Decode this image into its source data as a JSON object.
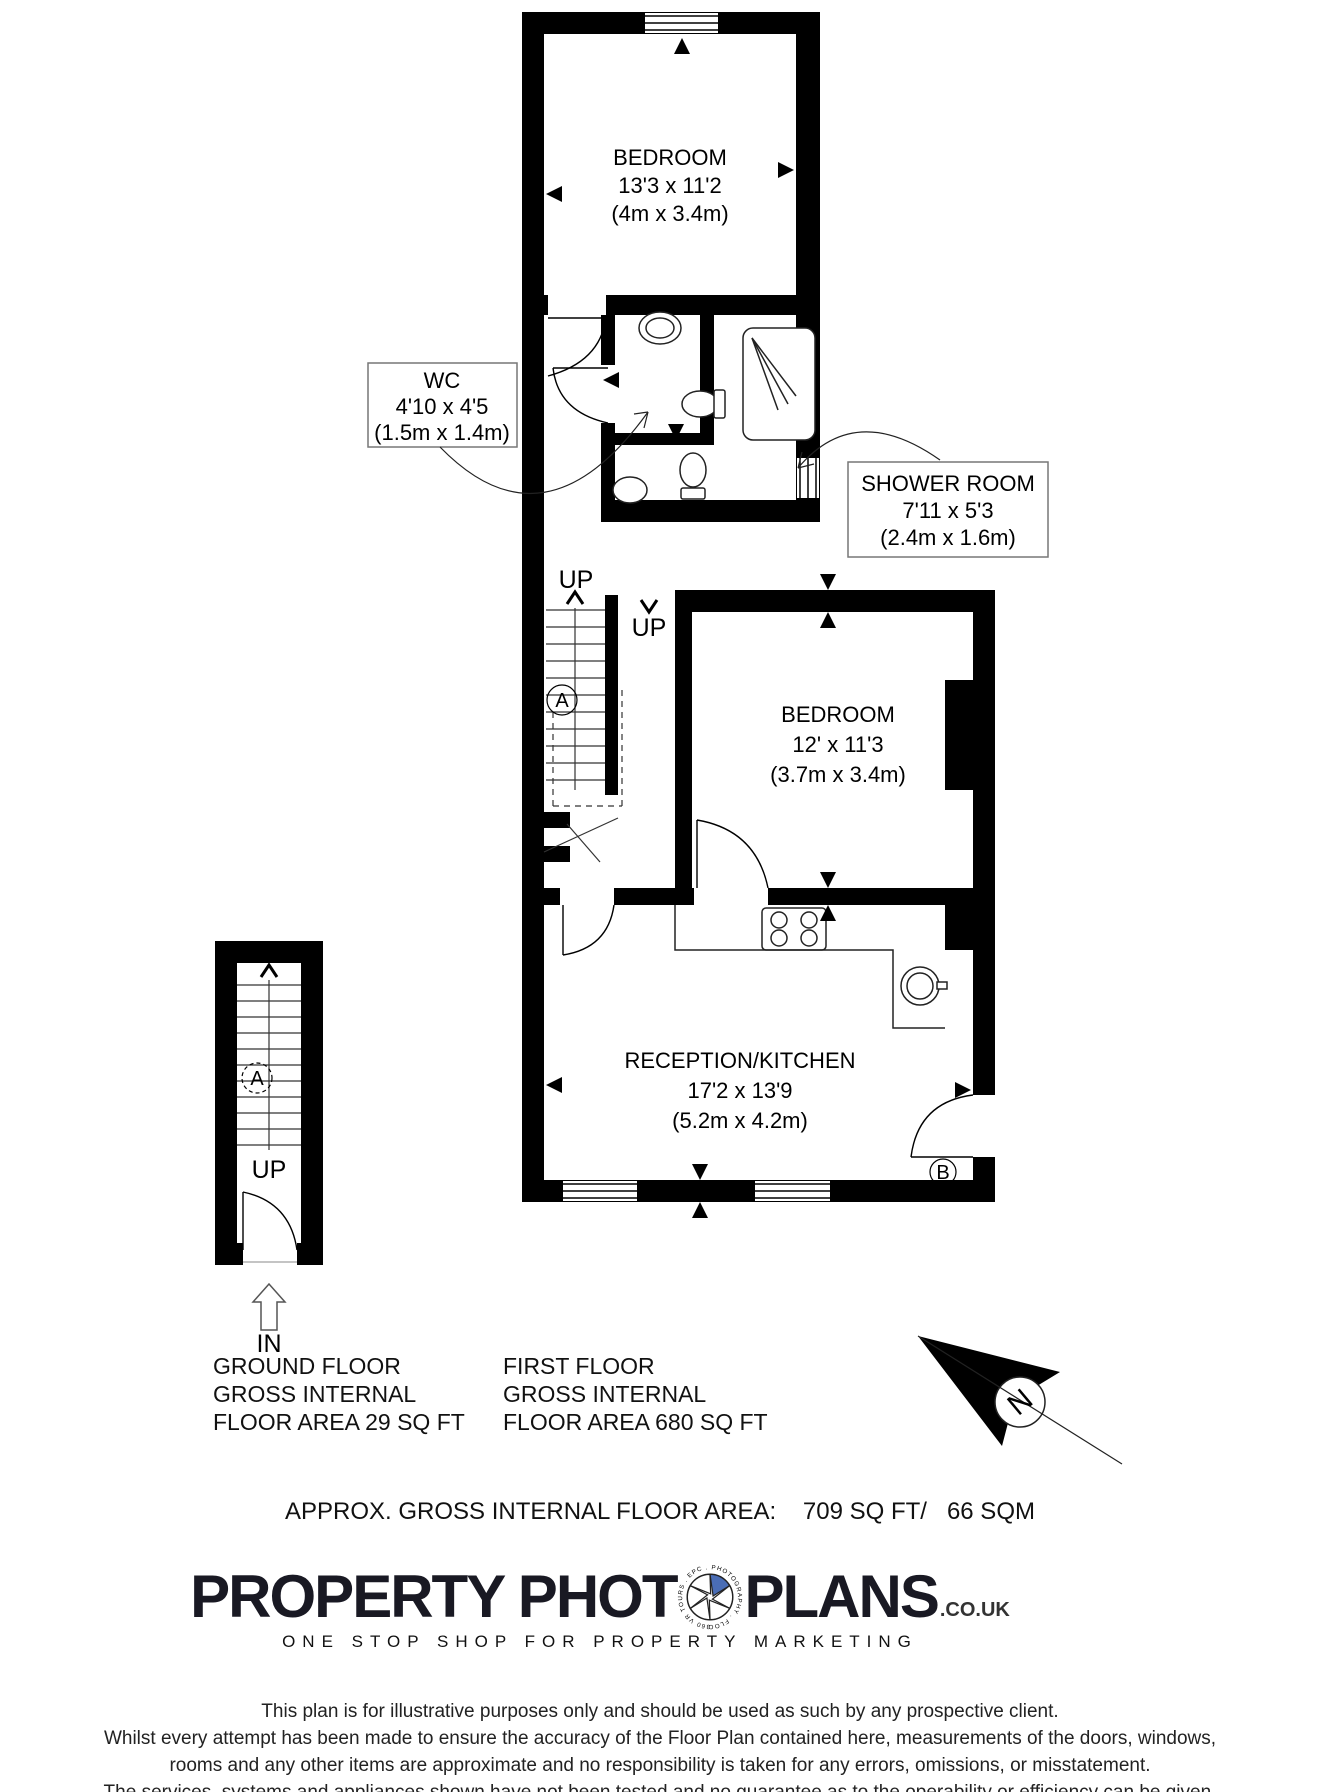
{
  "plan": {
    "rooms": {
      "bedroom1": {
        "name": "BEDROOM",
        "imperial": "13'3 x 11'2",
        "metric": "(4m x 3.4m)"
      },
      "wc": {
        "name": "WC",
        "imperial": "4'10 x 4'5",
        "metric": "(1.5m x 1.4m)"
      },
      "shower": {
        "name": "SHOWER ROOM",
        "imperial": "7'11 x 5'3",
        "metric": "(2.4m x 1.6m)"
      },
      "bedroom2": {
        "name": "BEDROOM",
        "imperial": "12' x 11'3",
        "metric": "(3.7m x 3.4m)"
      },
      "reception": {
        "name": "RECEPTION/KITCHEN",
        "imperial": "17'2 x 13'9",
        "metric": "(5.2m x 4.2m)"
      }
    },
    "labels": {
      "up": "UP",
      "in": "IN",
      "stair_ref": "A",
      "door_ref": "B",
      "north": "N"
    }
  },
  "captions": {
    "ground_floor": {
      "line1": "GROUND FLOOR",
      "line2": "GROSS INTERNAL",
      "line3": "FLOOR AREA 29 SQ FT"
    },
    "first_floor": {
      "line1": "FIRST FLOOR",
      "line2": "GROSS INTERNAL",
      "line3": "FLOOR AREA 680 SQ FT"
    },
    "total_area": "APPROX. GROSS INTERNAL FLOOR AREA:    709 SQ FT/   66 SQM"
  },
  "branding": {
    "logo_part1": "PROPERTY PHOT",
    "logo_part2": "PLANS",
    "logo_suffix": ".CO.UK",
    "icon_text": "360 VR TOURS . EPC . PHOTOGRAPHY . FLOOR PLANS .",
    "tagline": "ONE STOP SHOP FOR PROPERTY MARKETING",
    "accent_blue": "#4a6db5"
  },
  "disclaimer": {
    "line1": "This plan is for illustrative purposes only and should be used as such by any prospective client.",
    "line2": "Whilst every attempt has been made to ensure the accuracy of the Floor Plan contained here, measurements of the doors, windows,",
    "line3": "rooms and any other items are approximate and no responsibility is taken for any errors, omissions, or misstatement.",
    "line4": "The services, systems and appliances shown have not been tested and no guarantee as to the operability or efficiency can be given."
  }
}
